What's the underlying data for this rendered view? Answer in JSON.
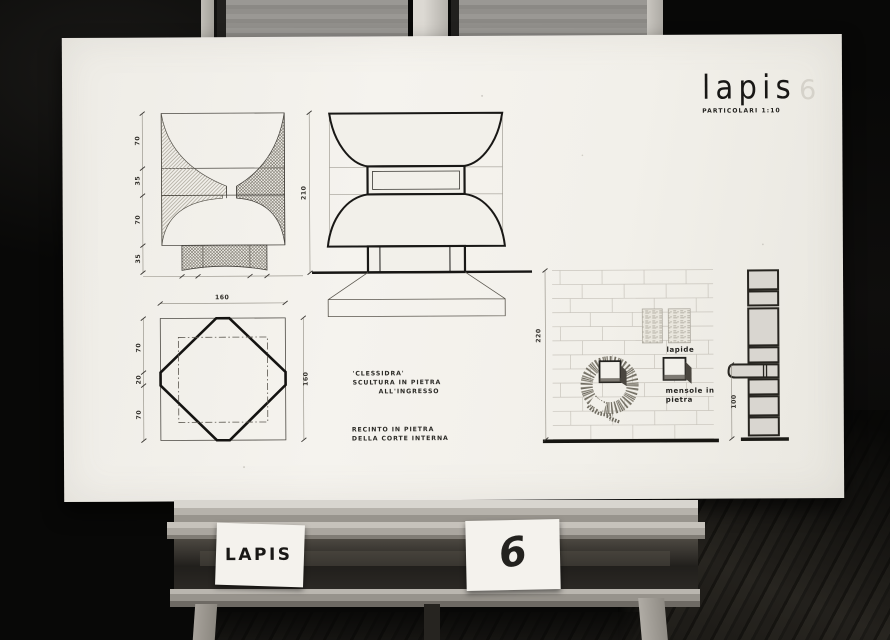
{
  "title_block": {
    "title": "lapis",
    "sheet_number": "6",
    "subtitle": "PARTICOLARI 1:10"
  },
  "notes": {
    "clessidra_line1": "'CLESSIDRA'",
    "clessidra_line2": "SCULTURA IN PIETRA",
    "clessidra_line3": "ALL'INGRESSO",
    "recinto_line1": "RECINTO IN PIETRA",
    "recinto_line2": "DELLA CORTE INTERNA"
  },
  "labels": {
    "lapide": "lapide",
    "mensole_line1": "mensole in",
    "mensole_line2": "pietra"
  },
  "dims": {
    "section_left": [
      "70",
      "35",
      "70",
      "35"
    ],
    "height": "210",
    "plan_top": "160",
    "plan_left": [
      "70",
      "20",
      "70"
    ],
    "plan_right": "160",
    "wall_left": "220",
    "wall_right": "100"
  },
  "cards": {
    "left": "LAPIS",
    "right": "6"
  },
  "colors": {
    "paper": "#f2f0ea",
    "ink": "#1a1917",
    "ghost_number": "#d5d2ca"
  }
}
